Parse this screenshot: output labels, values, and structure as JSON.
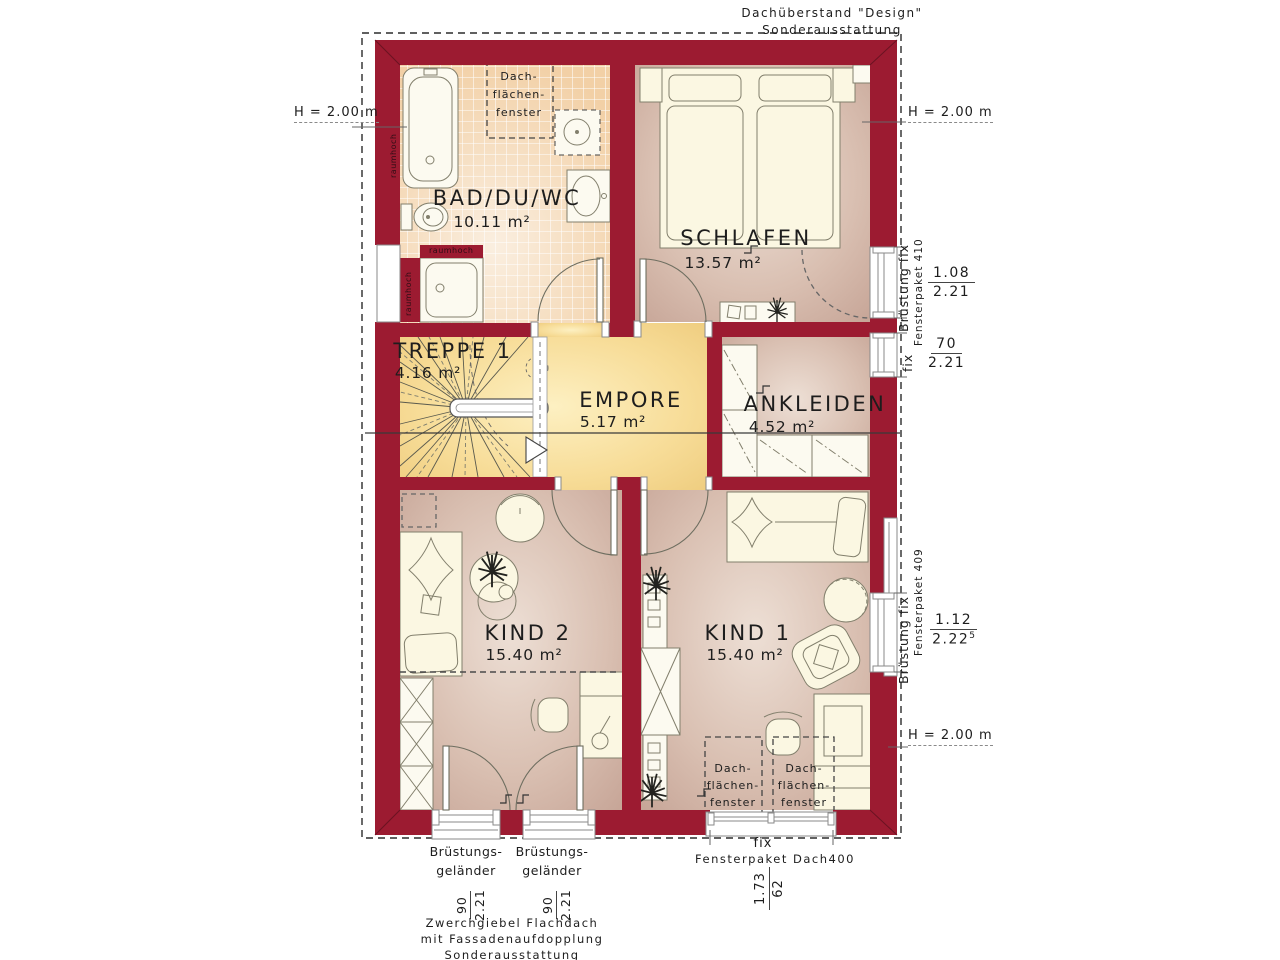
{
  "title_note": {
    "line1": "Dachüberstand \"Design\"",
    "line2": "Sonderausstattung"
  },
  "height_label": "H = 2.00 m",
  "raumhoch_label": "raumhoch",
  "roof_window_label": {
    "l1": "Dach-",
    "l2": "flächen-",
    "l3": "fenster"
  },
  "rooms": {
    "bad": {
      "name": "BAD/DU/WC",
      "area": "10.11 m²"
    },
    "schlafen": {
      "name": "SCHLAFEN",
      "area": "13.57 m²"
    },
    "treppe": {
      "name": "TREPPE 1",
      "area": "4.16 m²"
    },
    "empore": {
      "name": "EMPORE",
      "area": "5.17 m²"
    },
    "ankleiden": {
      "name": "ANKLEIDEN",
      "area": "4.52 m²"
    },
    "kind2": {
      "name": "KIND 2",
      "area": "15.40 m²"
    },
    "kind1": {
      "name": "KIND 1",
      "area": "15.40 m²"
    }
  },
  "windows": {
    "fp410": {
      "type": "Brüstung fix",
      "product": "Fensterpaket 410",
      "w": "1.08",
      "h": "2.21"
    },
    "fix70": {
      "type": "fix",
      "w": "70",
      "h": "2.21"
    },
    "fp409": {
      "type": "Brüstung fix",
      "product": "Fensterpaket 409",
      "w": "1.12",
      "h": "2.22",
      "h_sup": "5"
    },
    "dach400": {
      "type": "fix",
      "product": "Fensterpaket Dach400",
      "w": "1.73",
      "h": "62"
    },
    "balcony_rail": {
      "label1": "Brüstungs-",
      "label2": "geländer",
      "w": "90",
      "h": "2.21"
    }
  },
  "footer_note": {
    "line1": "Zwerchgiebel Flachdach",
    "line2": "mit Fassadenaufdopplung",
    "line3": "Sonderausstattung"
  },
  "colors": {
    "wall": "#9c1b31",
    "floor_warm": "#d9bfb1",
    "floor_yellow": "#f6d993",
    "tile": "#f2d0a6",
    "furniture": "#fbf7e2"
  }
}
